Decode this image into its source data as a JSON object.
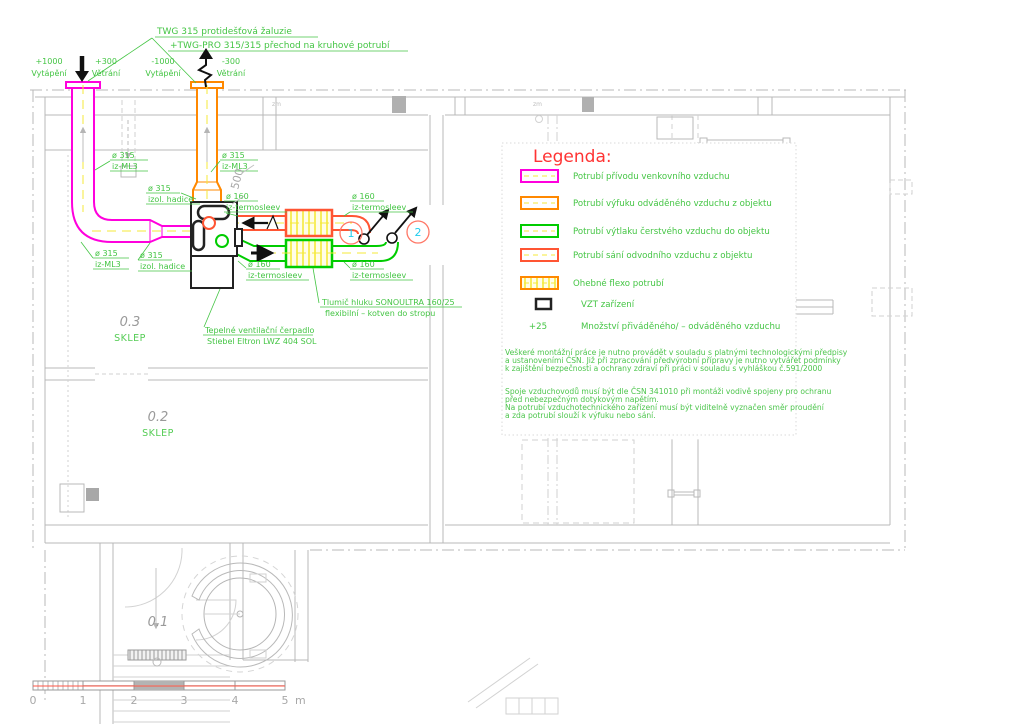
{
  "colors": {
    "supply_outdoor_magenta": "#ff00dd",
    "exhaust_orange": "#ff8800",
    "fresh_supply_green": "#00cc00",
    "extract_red": "#ff5533",
    "legend_title_red": "#ff3333",
    "annotation_green": "#44c544",
    "centerline_yellow": "#f5e93a",
    "marker_cyan": "#22ccee",
    "plan_gray": "#b9b9b9",
    "scale_red_line": "#ff5544"
  },
  "top_note": {
    "line1": "TWG 315 protidešťová žaluzie",
    "line2": "+TWG-PRO 315/315 přechod na kruhové potrubí"
  },
  "flows": [
    {
      "value": "+1000",
      "label": "Vytápění"
    },
    {
      "value": "+300",
      "label": "Větrání"
    },
    {
      "value": "-1000",
      "label": "Vytápění"
    },
    {
      "value": "-300",
      "label": "Větrání"
    }
  ],
  "duct_labels": {
    "dn315": "ø 315",
    "dn160": "ø 160",
    "iz_ml3": "iz-ML3",
    "izol_hadice": "izol. hadice",
    "iz_termosleev": "iz-termosleev"
  },
  "dimension_500": "500",
  "equipment": {
    "silencer_line1": "Tlumič hluku SONOULTRA 160/25",
    "silencer_line2": "flexibilní – kotven do stropu",
    "heat_pump_line1": "Tepelné ventilační čerpadlo",
    "heat_pump_line2": "Stiebel Eltron LWZ 404 SOL"
  },
  "rooms": [
    {
      "number": "0.3",
      "name": "SKLEP"
    },
    {
      "number": "0.2",
      "name": "SKLEP"
    },
    {
      "number": "0.1",
      "name": ""
    }
  ],
  "duct_markers": [
    "1",
    "2"
  ],
  "shaft_label": "zm",
  "legend": {
    "title": "Legenda:",
    "items": [
      {
        "label": "Potrubí přívodu venkovního vzduchu",
        "color": "#ff00dd",
        "type": "duct"
      },
      {
        "label": "Potrubí výfuku odváděného vzduchu z objektu",
        "color": "#ff8800",
        "type": "duct"
      },
      {
        "label": "Potrubí výtlaku čerstvého vzduchu do objektu",
        "color": "#00cc00",
        "type": "duct"
      },
      {
        "label": "Potrubí sání odvodního vzduchu z objektu",
        "color": "#ff5533",
        "type": "duct"
      },
      {
        "label": "Ohebné flexo potrubí",
        "color": "#ff8800",
        "type": "flex"
      },
      {
        "label": "VZT zařízení",
        "color": "#222222",
        "type": "unit"
      },
      {
        "label": "Množství přiváděného/ – odváděného vzduchu",
        "symbol": "+25",
        "type": "amount"
      }
    ]
  },
  "notes": {
    "para1": [
      "Veškeré montážní práce je nutno provádět v souladu s platnými technologickými předpisy",
      "a ustanoveními ČSN. Již při zpracování předvýrobní přípravy je nutno vytvářet podmínky",
      "k zajištění bezpečnosti a ochrany zdraví při práci v souladu s vyhláškou č.591/2000"
    ],
    "para2": [
      "Spoje vzduchovodů musí být dle ČSN 341010 při montáži vodivě spojeny pro ochranu",
      "před nebezpečným dotykovým napětím.",
      "Na potrubí vzduchotechnického zařízení musí být viditelně vyznačen směr proudění",
      "a zda potrubí slouží k výfuku nebo sání."
    ]
  },
  "scale_bar": {
    "ticks": [
      "0",
      "1",
      "2",
      "3",
      "4",
      "5"
    ],
    "unit": "m"
  }
}
